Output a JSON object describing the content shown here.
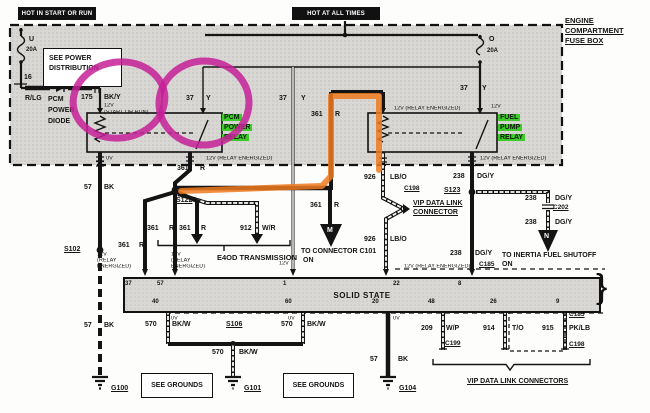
{
  "banners": {
    "hot_start": "HOT IN START OR RUN",
    "hot_all": "HOT AT ALL TIMES"
  },
  "fusebox": {
    "name_l1": "ENGINE",
    "name_l2": "COMPARTMENT",
    "name_l3": "FUSE BOX",
    "fuse_u": {
      "letter": "U",
      "amps": "20A",
      "pin": "16"
    },
    "fuse_o": {
      "letter": "O",
      "amps": "20A"
    }
  },
  "see_power": {
    "l1": "SEE POWER",
    "l2": "DISTRIBUTION"
  },
  "diode": {
    "wire": "R/LG",
    "l1": "PCM",
    "l2": "POWER",
    "l3": "DIODE"
  },
  "pcm_relay": {
    "l1": "PCM",
    "l2": "POWER",
    "l3": "RELAY"
  },
  "fuel_relay": {
    "l1": "FUEL",
    "l2": "PUMP",
    "l3": "RELAY"
  },
  "volts": {
    "v0": "0V",
    "v12": "12V",
    "v12re": "12V (RELAY ENERGIZED)",
    "start_or_run": "(START OR RUN)",
    "re_l1": "12V",
    "re_l2": "(RELAY",
    "re_l3": "ENERGIZED)"
  },
  "circuits": {
    "c37": "37",
    "y": "Y",
    "c361": "361",
    "r": "R",
    "c175": "175",
    "bky": "BK/Y",
    "c57": "57",
    "bk": "BK",
    "c912": "912",
    "wr": "W/R",
    "c926": "926",
    "lbo": "LB/O",
    "c238": "238",
    "dgy": "DG/Y",
    "c570": "570",
    "bkw": "BK/W",
    "c209": "209",
    "wp": "W/P",
    "c914": "914",
    "to": "T/O",
    "c915": "915",
    "pklb": "PK/LB"
  },
  "splices": {
    "s102": "S102",
    "s106": "S106",
    "s122": "S122",
    "s123": "S123"
  },
  "grounds": {
    "g100": "G100",
    "g101": "G101",
    "g104": "G104"
  },
  "connectors": {
    "c198": "C198",
    "c199": "C199",
    "c202": "C202",
    "c185": "C185"
  },
  "solid_state": {
    "label": "SOLID STATE",
    "pins_top": [
      "37",
      "57",
      "1",
      "22",
      "8"
    ],
    "pins_bottom": [
      "40",
      "60",
      "20",
      "48",
      "26",
      "9"
    ]
  },
  "dest": {
    "e4od": "E4OD TRANSMISSION",
    "m": "M",
    "c101_l1": "TO CONNECTOR C101",
    "c101_l2": "ON",
    "n": "N",
    "inertia_l1": "TO INERTIA FUEL SHUTOFF",
    "inertia_l2": "ON",
    "vip_l1": "VIP DATA LINK",
    "vip_l2": "CONNECTOR",
    "vip_all": "VIP DATA LINK CONNECTORS"
  },
  "notes": {
    "see_grounds": "SEE GROUNDS"
  },
  "annotation_colors": {
    "magenta": "#c62096",
    "orange": "#ef7a1e",
    "green": "#3ccc28"
  }
}
